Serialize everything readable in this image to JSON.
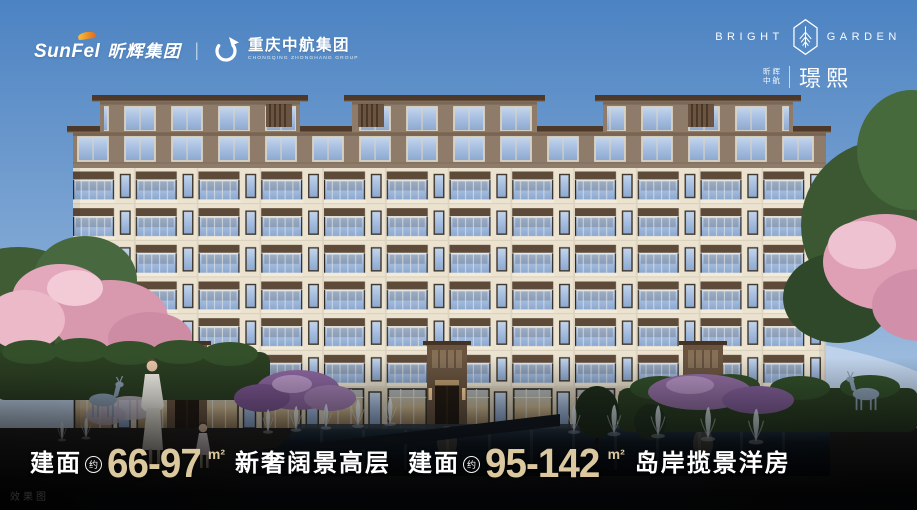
{
  "brand_left": {
    "sunfel_en": "SunFel",
    "sunfel_cn": "昕辉集团",
    "divider": "|",
    "zhonghang_cn": "重庆中航集团",
    "zhonghang_en": "CHONGQING ZHONGHANG GROUP"
  },
  "brand_right": {
    "name_left": "BRIGHT",
    "name_right": "GARDEN",
    "owner_top": "昕辉",
    "owner_bottom": "中航",
    "project_name": "璟熙"
  },
  "headline": {
    "left": {
      "prefix": "建面",
      "approx": "约",
      "range": "66-97",
      "unit": "m²",
      "title": "新奢阔景高层"
    },
    "right": {
      "prefix": "建面",
      "approx": "约",
      "range": "95-142",
      "unit": "m²",
      "title": "岛岸揽景洋房"
    }
  },
  "watermark": "效果图",
  "colors": {
    "accent_gold": "#DCC89F",
    "sky_top": "#4C83C2",
    "text_white": "#FFFFFF",
    "penthouse_brown": "#8E7B6A",
    "roof_brown": "#4C3929",
    "facade_cream": "#EBE3D0"
  }
}
